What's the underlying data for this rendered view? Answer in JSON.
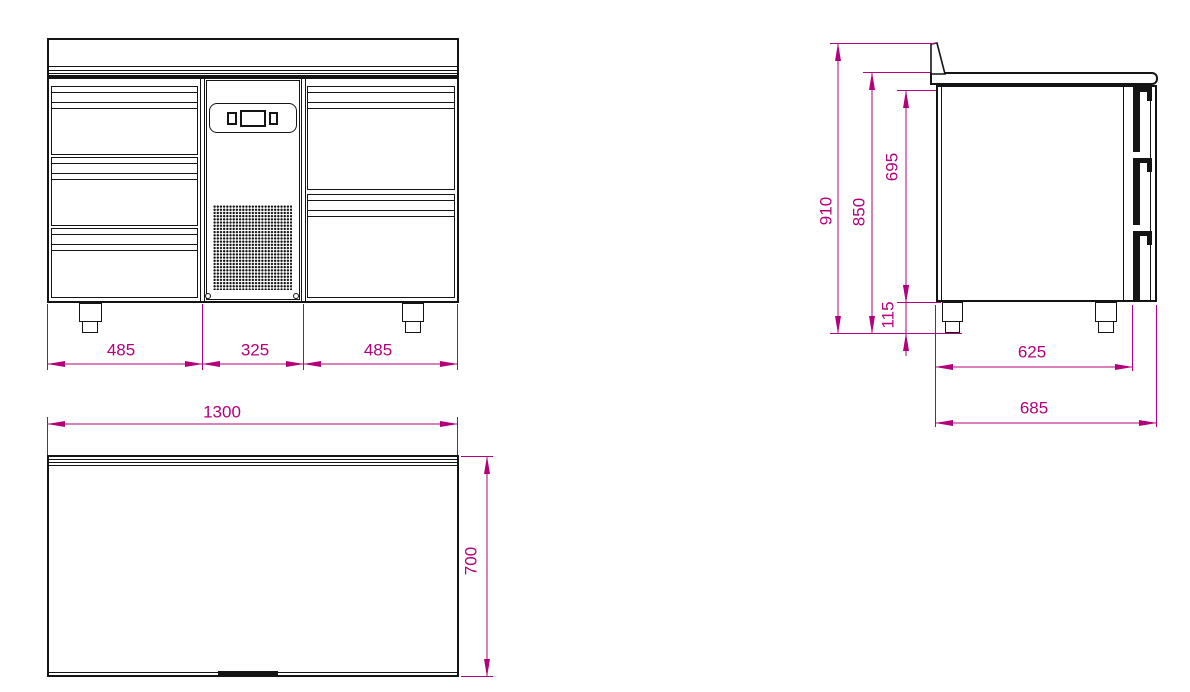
{
  "dimensions": {
    "front_view": {
      "section_widths": [
        "485",
        "325",
        "485"
      ]
    },
    "plan_view": {
      "total_width": "1300",
      "total_depth": "700"
    },
    "side_view": {
      "total_height": "910",
      "worktop_height": "850",
      "drawer_section_height": "695",
      "leg_height": "115",
      "body_depth": "625",
      "total_depth": "685"
    }
  },
  "colors": {
    "dimension_color": "#B4007A",
    "outline_color": "#141414",
    "background": "#FFFFFF"
  }
}
